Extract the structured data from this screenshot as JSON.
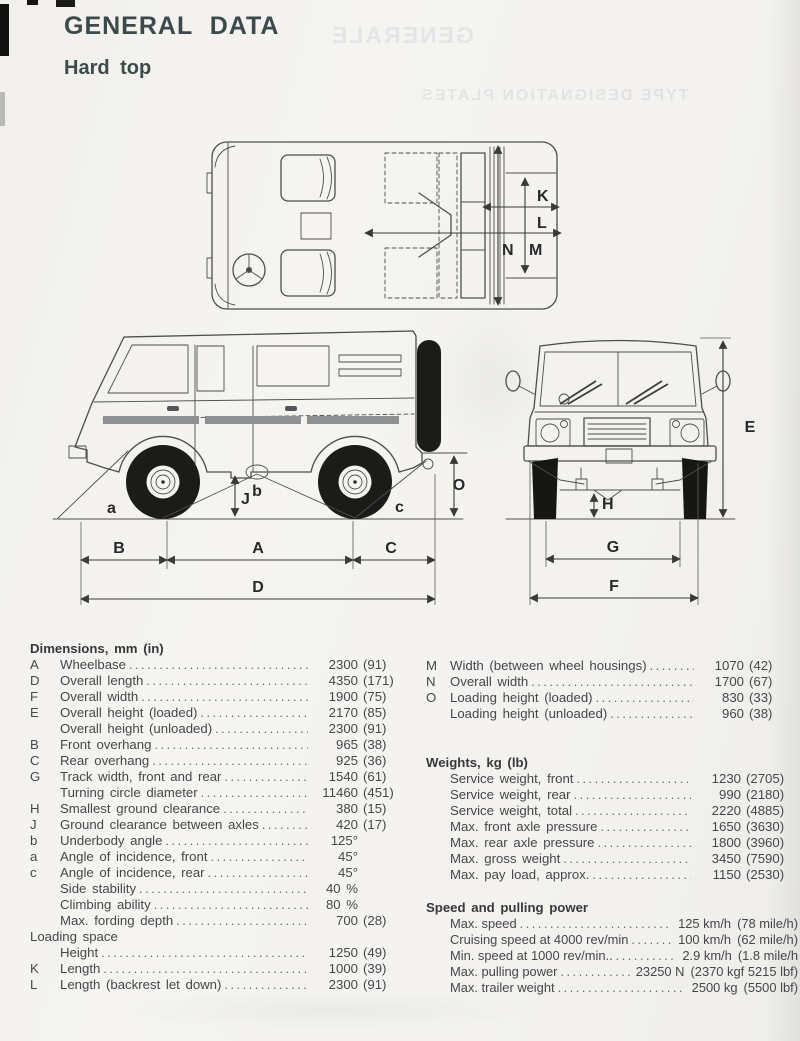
{
  "page": {
    "title": "GENERAL DATA",
    "subtitle": "Hard top"
  },
  "bleed_through": {
    "line1": "GENERALE",
    "line2": "TYPE DESIGNATION PLATES"
  },
  "colors": {
    "paper": "#f3f2ef",
    "ink": "#43484b",
    "heading": "#3d4a4c",
    "drawing_line": "#4e4e4c",
    "tire_black": "#1b1b1a"
  },
  "drawings": {
    "top_view": {
      "labels": {
        "K": "K",
        "L": "L",
        "N": "N",
        "M": "M"
      }
    },
    "side_view": {
      "labels": {
        "a": "a",
        "b": "b",
        "c": "c",
        "J": "J",
        "O": "O",
        "B": "B",
        "A": "A",
        "C": "C",
        "D": "D"
      }
    },
    "front_view": {
      "labels": {
        "E": "E",
        "H": "H",
        "G": "G",
        "F": "F"
      }
    }
  },
  "dimensions_table": {
    "header": "Dimensions, mm (in)",
    "rows": [
      {
        "k": "A",
        "l": "Wheelbase",
        "v1": "2300",
        "v2": "(91)"
      },
      {
        "k": "D",
        "l": "Overall length",
        "v1": "4350",
        "v2": "(171)"
      },
      {
        "k": "F",
        "l": "Overall width",
        "v1": "1900",
        "v2": "(75)"
      },
      {
        "k": "E",
        "l": "Overall height (loaded)",
        "v1": "2170",
        "v2": "(85)"
      },
      {
        "k": "",
        "l": "Overall height (unloaded)",
        "v1": "2300",
        "v2": "(91)"
      },
      {
        "k": "B",
        "l": "Front overhang",
        "v1": "965",
        "v2": "(38)"
      },
      {
        "k": "C",
        "l": "Rear overhang",
        "v1": "925",
        "v2": "(36)"
      },
      {
        "k": "G",
        "l": "Track width, front and rear",
        "v1": "1540",
        "v2": "(61)"
      },
      {
        "k": "",
        "l": "Turning circle diameter",
        "v1": "11460",
        "v2": "(451)"
      },
      {
        "k": "H",
        "l": "Smallest ground clearance",
        "v1": "380",
        "v2": "(15)"
      },
      {
        "k": "J",
        "l": "Ground clearance between axles",
        "v1": "420",
        "v2": "(17)"
      },
      {
        "k": "b",
        "l": "Underbody angle",
        "v1": "125°",
        "v2": ""
      },
      {
        "k": "a",
        "l": "Angle of incidence, front",
        "v1": "45°",
        "v2": ""
      },
      {
        "k": "c",
        "l": "Angle of incidence, rear",
        "v1": "45°",
        "v2": ""
      },
      {
        "k": "",
        "l": "Side stability",
        "v1": "40 %",
        "v2": ""
      },
      {
        "k": "",
        "l": "Climbing ability",
        "v1": "80 %",
        "v2": ""
      },
      {
        "k": "",
        "l": "Max. fording depth",
        "v1": "700",
        "v2": "(28)"
      },
      {
        "k": "",
        "l": "Loading space",
        "v1": "",
        "v2": "",
        "cls": "sec"
      },
      {
        "k": "",
        "l": "Height",
        "v1": "1250",
        "v2": "(49)"
      },
      {
        "k": "K",
        "l": "Length",
        "v1": "1000",
        "v2": "(39)"
      },
      {
        "k": "L",
        "l": "Length (backrest let down)",
        "v1": "2300",
        "v2": "(91)"
      }
    ]
  },
  "dimensions_table_right": {
    "rows": [
      {
        "k": "M",
        "l": "Width (between wheel housings)",
        "v1": "1070",
        "v2": "(42)"
      },
      {
        "k": "N",
        "l": "Overall width",
        "v1": "1700",
        "v2": "(67)"
      },
      {
        "k": "O",
        "l": "Loading height (loaded)",
        "v1": "830",
        "v2": "(33)"
      },
      {
        "k": "",
        "l": "Loading height (unloaded)",
        "v1": "960",
        "v2": "(38)"
      }
    ]
  },
  "weights_table": {
    "header": "Weights, kg (lb)",
    "rows": [
      {
        "k": "",
        "l": "Service weight, front",
        "v1": "1230",
        "v2": "(2705)"
      },
      {
        "k": "",
        "l": "Service weight, rear",
        "v1": "990",
        "v2": "(2180)"
      },
      {
        "k": "",
        "l": "Service weight, total",
        "v1": "2220",
        "v2": "(4885)"
      },
      {
        "k": "",
        "l": "Max. front axle pressure",
        "v1": "1650",
        "v2": "(3630)"
      },
      {
        "k": "",
        "l": "Max. rear axle pressure",
        "v1": "1800",
        "v2": "(3960)"
      },
      {
        "k": "",
        "l": "Max. gross weight",
        "v1": "3450",
        "v2": "(7590)"
      },
      {
        "k": "",
        "l": "Max. pay load, approx.",
        "v1": "1150",
        "v2": "(2530)"
      }
    ]
  },
  "speed_table": {
    "header": "Speed and pulling power",
    "rows": [
      {
        "k": "",
        "l": "Max. speed",
        "v1": "125 km/h",
        "v2": "(78 mile/h)"
      },
      {
        "k": "",
        "l": "Cruising speed at 4000 rev/min",
        "v1": "100 km/h",
        "v2": "(62 mile/h)"
      },
      {
        "k": "",
        "l": "Min. speed at 1000 rev/min..",
        "v1": "2.9 km/h",
        "v2": "(1.8 mile/h"
      },
      {
        "k": "",
        "l": "Max. pulling power",
        "v1": "23250 N",
        "v2": "(2370 kgf 5215 lbf)"
      },
      {
        "k": "",
        "l": "Max. trailer weight",
        "v1": "2500 kg",
        "v2": "(5500 lbf)"
      }
    ]
  }
}
